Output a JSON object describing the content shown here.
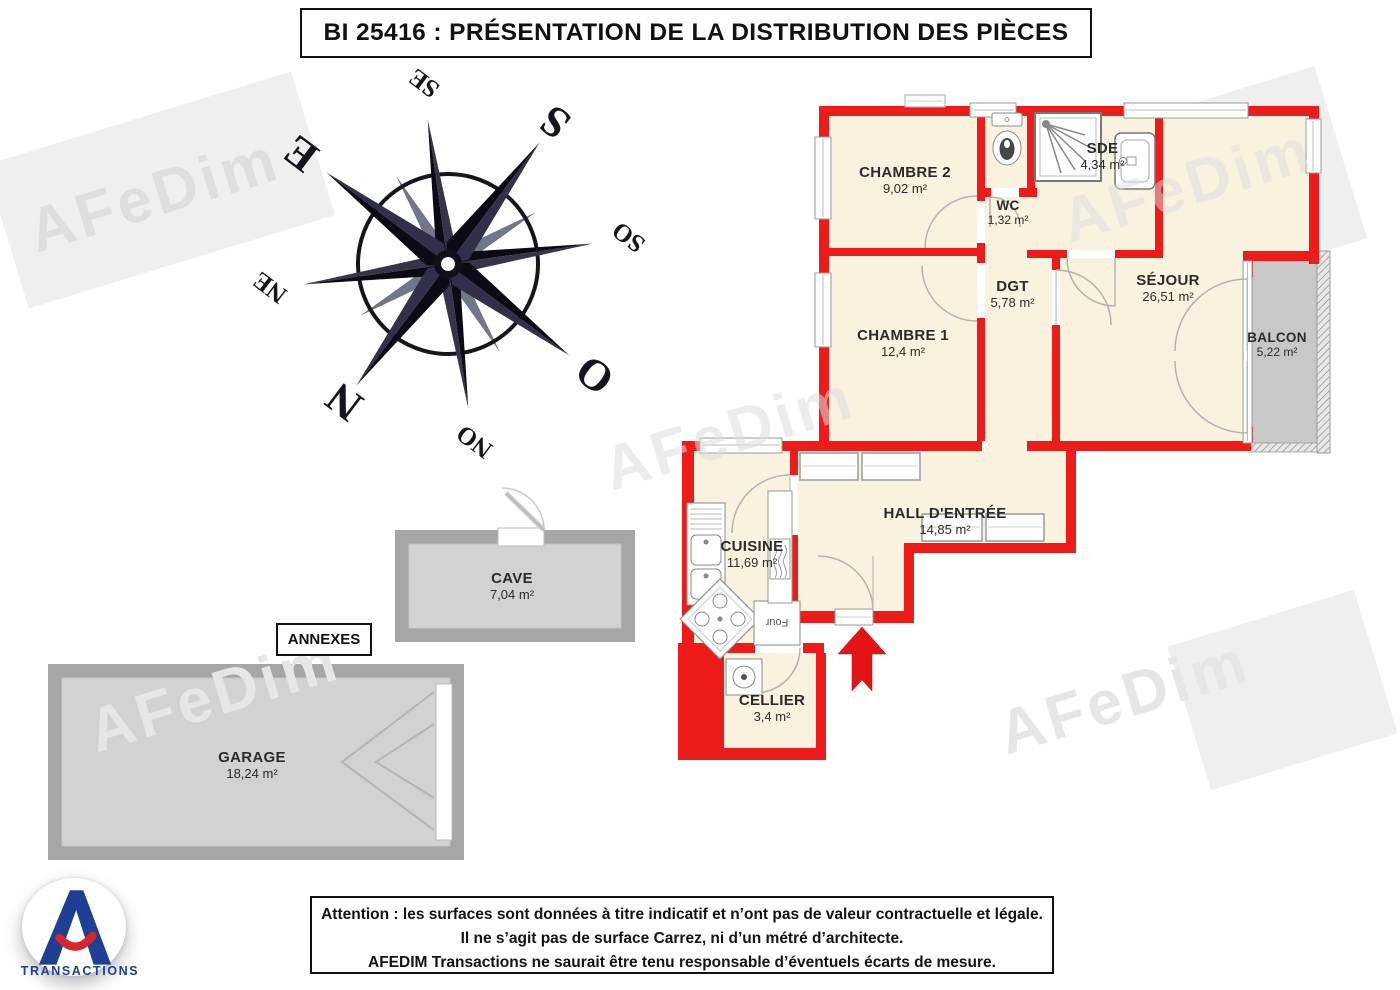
{
  "title": "BI 25416 : PRÉSENTATION DE LA DISTRIBUTION DES PIÈCES",
  "compass": {
    "labels": {
      "n": "N",
      "s": "S",
      "e": "E",
      "o": "O",
      "ne": "NE",
      "se": "SE",
      "so": "SO",
      "no": "NO"
    }
  },
  "rooms": {
    "chambre2": {
      "name": "CHAMBRE 2",
      "area": "9,02 m²"
    },
    "wc": {
      "name": "WC",
      "area": "1,32 m²"
    },
    "sde": {
      "name": "SDE",
      "area": "4,34 m²"
    },
    "dgt": {
      "name": "DGT",
      "area": "5,78 m²"
    },
    "sejour": {
      "name": "SÉJOUR",
      "area": "26,51 m²"
    },
    "balcon": {
      "name": "BALCON",
      "area": "5,22 m²"
    },
    "chambre1": {
      "name": "CHAMBRE 1",
      "area": "12,4 m²"
    },
    "cuisine": {
      "name": "CUISINE",
      "area": "11,69 m²"
    },
    "hall": {
      "name": "HALL D'ENTRÉE",
      "area": "14,85 m²"
    },
    "cellier": {
      "name": "CELLIER",
      "area": "3,4 m²"
    }
  },
  "annexes": {
    "label": "ANNEXES",
    "cave": {
      "name": "CAVE",
      "area": "7,04 m²"
    },
    "garage": {
      "name": "GARAGE",
      "area": "18,24 m²"
    }
  },
  "fixtures": {
    "oven": "Four"
  },
  "watermark": {
    "text": "AFeDim"
  },
  "footer": {
    "line1": "Attention : les surfaces sont données à titre indicatif et n’ont pas de valeur contractuelle et légale.",
    "line2": "Il ne s’agit pas de surface Carrez, ni d’un métré d’architecte.",
    "line3": "AFEDIM Transactions ne saurait être tenu responsable d’éventuels écarts de mesure."
  },
  "logo": {
    "brand": "TRANSACTIONS"
  },
  "colors": {
    "wall_red": "#ee1b1b",
    "room_fill": "#f8f2df",
    "annex_wall": "#a6a6a6",
    "annex_fill": "#d2d2d2",
    "logo_blue": "#1e3f94",
    "logo_red": "#d6252b"
  }
}
